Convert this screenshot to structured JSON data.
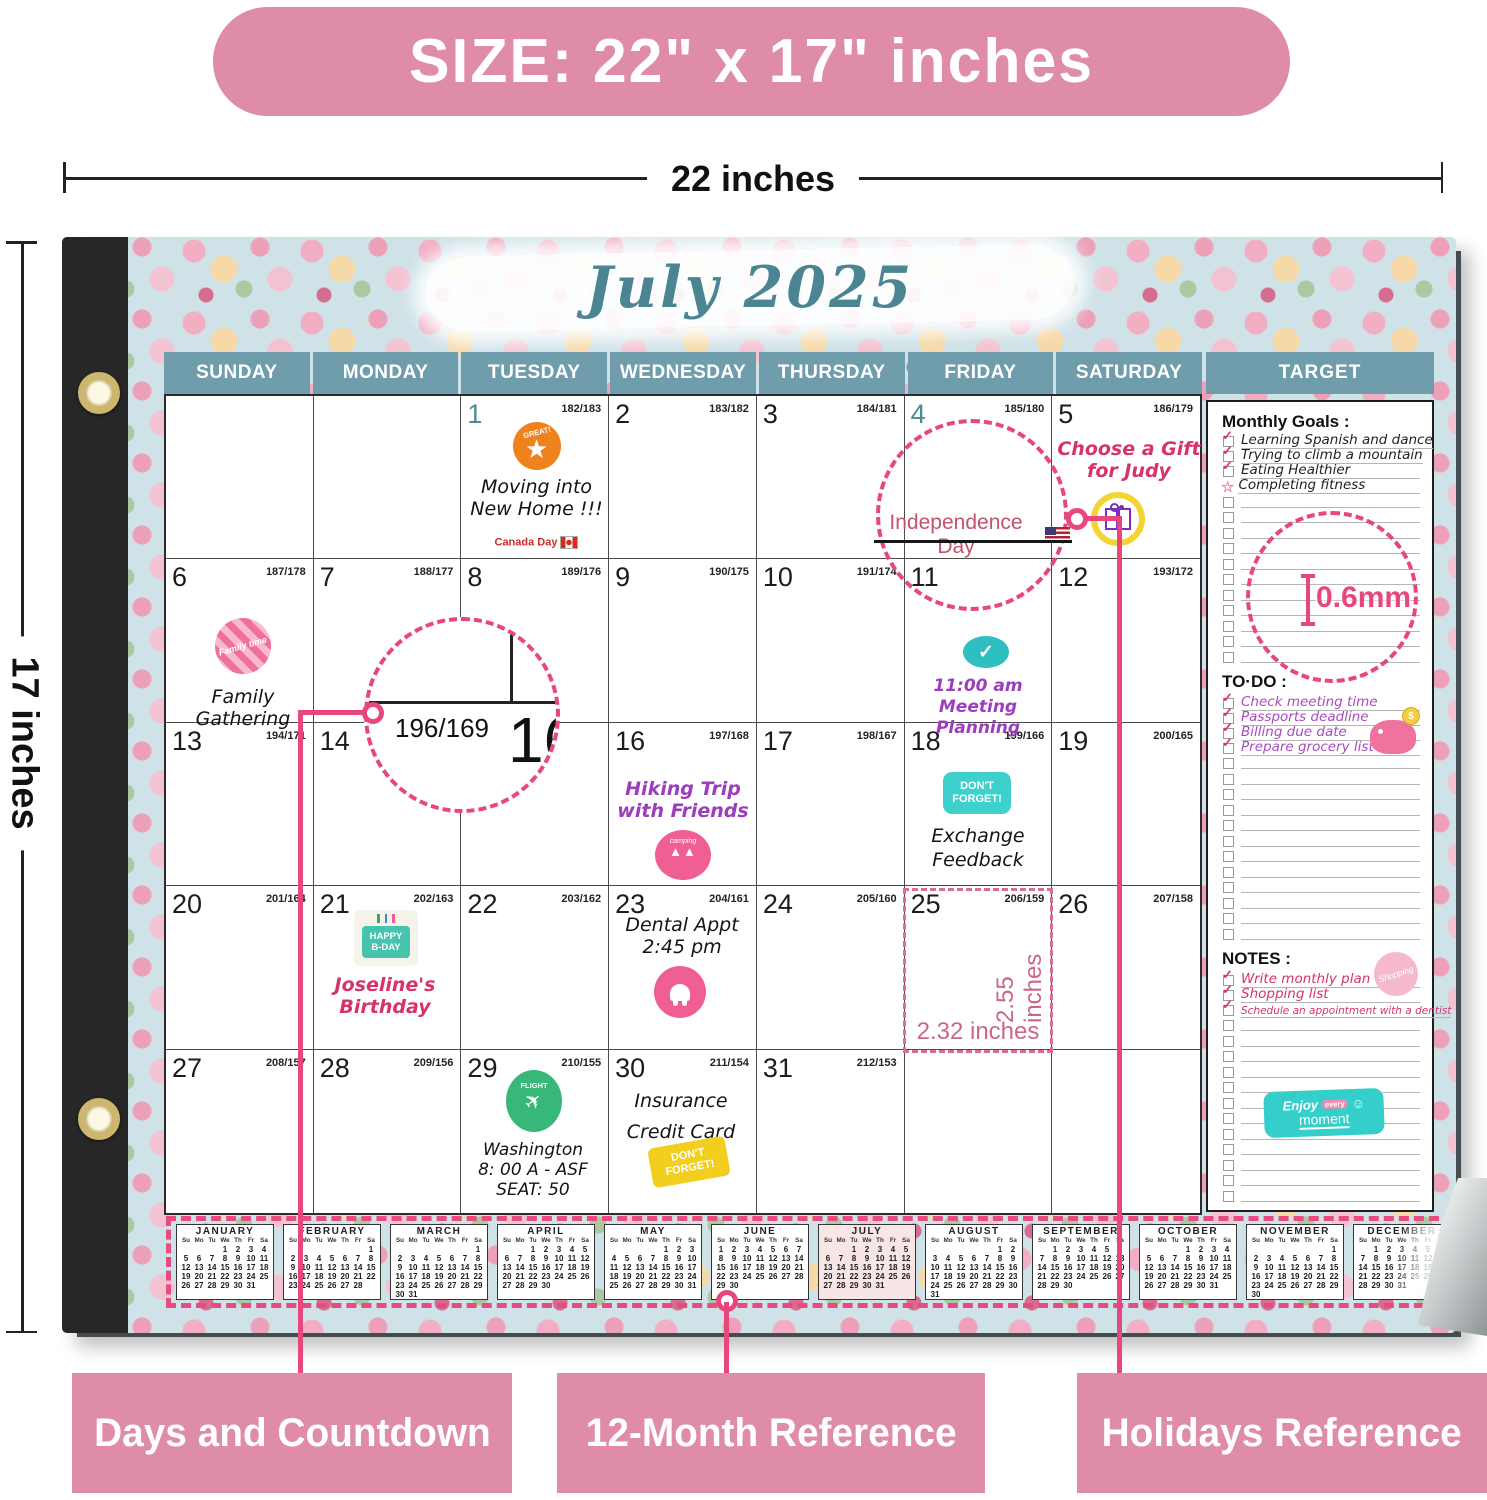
{
  "size_banner": "SIZE: 22\" x 17\" inches",
  "dim_width": "22 inches",
  "dim_height": "17 inches",
  "month_title": "July 2025",
  "day_headers": [
    "SUNDAY",
    "MONDAY",
    "TUESDAY",
    "WEDNESDAY",
    "THURSDAY",
    "FRIDAY",
    "SATURDAY"
  ],
  "target_header": "TARGET",
  "grid": {
    "cells": [
      {
        "day": "",
        "cd": ""
      },
      {
        "day": "",
        "cd": ""
      },
      {
        "day": "1",
        "cd": "182/183",
        "teal": true
      },
      {
        "day": "2",
        "cd": "183/182"
      },
      {
        "day": "3",
        "cd": "184/181"
      },
      {
        "day": "4",
        "cd": "185/180",
        "teal": true
      },
      {
        "day": "5",
        "cd": "186/179"
      },
      {
        "day": "6",
        "cd": "187/178"
      },
      {
        "day": "7",
        "cd": "188/177"
      },
      {
        "day": "8",
        "cd": "189/176"
      },
      {
        "day": "9",
        "cd": "190/175"
      },
      {
        "day": "10",
        "cd": "191/174"
      },
      {
        "day": "11",
        "cd": ""
      },
      {
        "day": "12",
        "cd": "193/172"
      },
      {
        "day": "13",
        "cd": "194/171"
      },
      {
        "day": "14",
        "cd": ""
      },
      {
        "day": "",
        "cd": ""
      },
      {
        "day": "16",
        "cd": "197/168"
      },
      {
        "day": "17",
        "cd": "198/167"
      },
      {
        "day": "18",
        "cd": "199/166"
      },
      {
        "day": "19",
        "cd": "200/165"
      },
      {
        "day": "20",
        "cd": "201/164"
      },
      {
        "day": "21",
        "cd": "202/163"
      },
      {
        "day": "22",
        "cd": "203/162"
      },
      {
        "day": "23",
        "cd": "204/161"
      },
      {
        "day": "24",
        "cd": "205/160"
      },
      {
        "day": "25",
        "cd": "206/159"
      },
      {
        "day": "26",
        "cd": "207/158"
      },
      {
        "day": "27",
        "cd": "208/157"
      },
      {
        "day": "28",
        "cd": "209/156"
      },
      {
        "day": "29",
        "cd": "210/155"
      },
      {
        "day": "30",
        "cd": "211/154"
      },
      {
        "day": "31",
        "cd": "212/153"
      },
      {
        "day": "",
        "cd": ""
      },
      {
        "day": "",
        "cd": ""
      }
    ]
  },
  "events": {
    "jul1": {
      "sticker": "GREAT!",
      "lines": [
        "Moving into",
        "New Home !!!"
      ],
      "holiday": "Canada Day"
    },
    "jul4": {
      "holiday": "Independence Day"
    },
    "jul5": {
      "lines": [
        "Choose a Gift",
        "for Judy"
      ]
    },
    "jul6": {
      "sticker": "Family time",
      "lines": [
        "Family",
        "Gathering"
      ]
    },
    "jul11": {
      "lines": [
        "11:00 am",
        "Meeting Planning"
      ],
      "check_icon": "✓"
    },
    "jul16": {
      "lines": [
        "Hiking Trip",
        "with Friends"
      ],
      "sticker": "camping",
      "tents": "▲▲"
    },
    "jul18": {
      "sticker_lines": [
        "DON'T",
        "FORGET!"
      ],
      "lines": [
        "Exchange",
        "Feedback"
      ]
    },
    "jul21": {
      "sticker_lines": [
        "HAPPY",
        "B-DAY"
      ],
      "lines": [
        "Joseline's",
        "Birthday"
      ]
    },
    "jul23": {
      "lines": [
        "Dental Appt",
        "2:45 pm"
      ]
    },
    "jul29": {
      "sticker": "FLIGHT",
      "plane_icon": "✈",
      "lines": [
        "Washington",
        "8: 00 A - ASF",
        "SEAT: 50"
      ]
    },
    "jul30": {
      "lines": [
        "Insurance",
        "Credit Card"
      ],
      "sticker_lines": [
        "DON'T",
        "FORGET!"
      ]
    }
  },
  "magnifier": {
    "countdown": "196/169",
    "big_day": "16"
  },
  "measure_cell": {
    "width_label": "2.32 inches",
    "height_label": "2.55 inches"
  },
  "target": {
    "goals_title": "Monthly Goals :",
    "goals": [
      "Learning Spanish and dance",
      "Trying to climb a mountain",
      "Eating Healthier",
      "Completing fitness"
    ],
    "measure_label": "0.6mm",
    "todo_title": "TO·DO :",
    "todos": [
      "Check meeting time",
      "Passports deadline",
      "Billing due date",
      "Prepare grocery list"
    ],
    "notes_title": "NOTES :",
    "notes": [
      "Write monthly plan",
      "Shopping list",
      "Schedule an appointment with a dentist"
    ],
    "coin_label": "$",
    "shopping_sticker": "Shopping",
    "moment_sticker": {
      "l1": "Enjoy",
      "l2": "every",
      "l3": "moment",
      "smiley": "☺"
    }
  },
  "mini_calendar": {
    "day_header": [
      "Su",
      "Mo",
      "Tu",
      "We",
      "Th",
      "Fr",
      "Sa"
    ],
    "months": [
      {
        "name": "JANUARY",
        "weeks": [
          [
            "",
            "",
            "",
            "1",
            "2",
            "3",
            "4"
          ],
          [
            "5",
            "6",
            "7",
            "8",
            "9",
            "10",
            "11"
          ],
          [
            "12",
            "13",
            "14",
            "15",
            "16",
            "17",
            "18"
          ],
          [
            "19",
            "20",
            "21",
            "22",
            "23",
            "24",
            "25"
          ],
          [
            "26",
            "27",
            "28",
            "29",
            "30",
            "31",
            ""
          ]
        ]
      },
      {
        "name": "FEBRUARY",
        "weeks": [
          [
            "",
            "",
            "",
            "",
            "",
            "",
            "1"
          ],
          [
            "2",
            "3",
            "4",
            "5",
            "6",
            "7",
            "8"
          ],
          [
            "9",
            "10",
            "11",
            "12",
            "13",
            "14",
            "15"
          ],
          [
            "16",
            "17",
            "18",
            "19",
            "20",
            "21",
            "22"
          ],
          [
            "23",
            "24",
            "25",
            "26",
            "27",
            "28",
            ""
          ]
        ]
      },
      {
        "name": "MARCH",
        "weeks": [
          [
            "",
            "",
            "",
            "",
            "",
            "",
            "1"
          ],
          [
            "2",
            "3",
            "4",
            "5",
            "6",
            "7",
            "8"
          ],
          [
            "9",
            "10",
            "11",
            "12",
            "13",
            "14",
            "15"
          ],
          [
            "16",
            "17",
            "18",
            "19",
            "20",
            "21",
            "22"
          ],
          [
            "23",
            "24",
            "25",
            "26",
            "27",
            "28",
            "29"
          ],
          [
            "30",
            "31",
            "",
            "",
            "",
            "",
            ""
          ]
        ]
      },
      {
        "name": "APRIL",
        "weeks": [
          [
            "",
            "",
            "1",
            "2",
            "3",
            "4",
            "5"
          ],
          [
            "6",
            "7",
            "8",
            "9",
            "10",
            "11",
            "12"
          ],
          [
            "13",
            "14",
            "15",
            "16",
            "17",
            "18",
            "19"
          ],
          [
            "20",
            "21",
            "22",
            "23",
            "24",
            "25",
            "26"
          ],
          [
            "27",
            "28",
            "29",
            "30",
            "",
            "",
            ""
          ]
        ]
      },
      {
        "name": "MAY",
        "weeks": [
          [
            "",
            "",
            "",
            "",
            "1",
            "2",
            "3"
          ],
          [
            "4",
            "5",
            "6",
            "7",
            "8",
            "9",
            "10"
          ],
          [
            "11",
            "12",
            "13",
            "14",
            "15",
            "16",
            "17"
          ],
          [
            "18",
            "19",
            "20",
            "21",
            "22",
            "23",
            "24"
          ],
          [
            "25",
            "26",
            "27",
            "28",
            "29",
            "30",
            "31"
          ]
        ]
      },
      {
        "name": "JUNE",
        "weeks": [
          [
            "1",
            "2",
            "3",
            "4",
            "5",
            "6",
            "7"
          ],
          [
            "8",
            "9",
            "10",
            "11",
            "12",
            "13",
            "14"
          ],
          [
            "15",
            "16",
            "17",
            "18",
            "19",
            "20",
            "21"
          ],
          [
            "22",
            "23",
            "24",
            "25",
            "26",
            "27",
            "28"
          ],
          [
            "29",
            "30",
            "",
            "",
            "",
            "",
            ""
          ]
        ]
      },
      {
        "name": "JULY",
        "highlight": true,
        "weeks": [
          [
            "",
            "",
            "1",
            "2",
            "3",
            "4",
            "5"
          ],
          [
            "6",
            "7",
            "8",
            "9",
            "10",
            "11",
            "12"
          ],
          [
            "13",
            "14",
            "15",
            "16",
            "17",
            "18",
            "19"
          ],
          [
            "20",
            "21",
            "22",
            "23",
            "24",
            "25",
            "26"
          ],
          [
            "27",
            "28",
            "29",
            "30",
            "31",
            "",
            ""
          ]
        ]
      },
      {
        "name": "AUGUST",
        "weeks": [
          [
            "",
            "",
            "",
            "",
            "",
            "1",
            "2"
          ],
          [
            "3",
            "4",
            "5",
            "6",
            "7",
            "8",
            "9"
          ],
          [
            "10",
            "11",
            "12",
            "13",
            "14",
            "15",
            "16"
          ],
          [
            "17",
            "18",
            "19",
            "20",
            "21",
            "22",
            "23"
          ],
          [
            "24",
            "25",
            "26",
            "27",
            "28",
            "29",
            "30"
          ],
          [
            "31",
            "",
            "",
            "",
            "",
            "",
            ""
          ]
        ]
      },
      {
        "name": "SEPTEMBER",
        "weeks": [
          [
            "",
            "1",
            "2",
            "3",
            "4",
            "5",
            "6"
          ],
          [
            "7",
            "8",
            "9",
            "10",
            "11",
            "12",
            "13"
          ],
          [
            "14",
            "15",
            "16",
            "17",
            "18",
            "19",
            "20"
          ],
          [
            "21",
            "22",
            "23",
            "24",
            "25",
            "26",
            "27"
          ],
          [
            "28",
            "29",
            "30",
            "",
            "",
            "",
            ""
          ]
        ]
      },
      {
        "name": "OCTOBER",
        "weeks": [
          [
            "",
            "",
            "",
            "1",
            "2",
            "3",
            "4"
          ],
          [
            "5",
            "6",
            "7",
            "8",
            "9",
            "10",
            "11"
          ],
          [
            "12",
            "13",
            "14",
            "15",
            "16",
            "17",
            "18"
          ],
          [
            "19",
            "20",
            "21",
            "22",
            "23",
            "24",
            "25"
          ],
          [
            "26",
            "27",
            "28",
            "29",
            "30",
            "31",
            ""
          ]
        ]
      },
      {
        "name": "NOVEMBER",
        "weeks": [
          [
            "",
            "",
            "",
            "",
            "",
            "",
            "1"
          ],
          [
            "2",
            "3",
            "4",
            "5",
            "6",
            "7",
            "8"
          ],
          [
            "9",
            "10",
            "11",
            "12",
            "13",
            "14",
            "15"
          ],
          [
            "16",
            "17",
            "18",
            "19",
            "20",
            "21",
            "22"
          ],
          [
            "23",
            "24",
            "25",
            "26",
            "27",
            "28",
            "29"
          ],
          [
            "30",
            "",
            "",
            "",
            "",
            "",
            ""
          ]
        ]
      },
      {
        "name": "DECEMBER",
        "fade": true,
        "weeks": [
          [
            "",
            "1",
            "2",
            "3",
            "4",
            "5",
            "6"
          ],
          [
            "7",
            "8",
            "9",
            "10",
            "11",
            "12",
            "13"
          ],
          [
            "14",
            "15",
            "16",
            "17",
            "18",
            "19",
            "20"
          ],
          [
            "21",
            "22",
            "23",
            "24",
            "25",
            "26",
            "27"
          ],
          [
            "28",
            "29",
            "30",
            "31",
            "",
            "",
            ""
          ]
        ]
      }
    ]
  },
  "footer_labels": [
    "Days and Countdown",
    "12-Month Reference",
    "Holidays Reference"
  ],
  "colors": {
    "accent_pink": "#e8477e",
    "label_pink": "#df8ca6",
    "header_teal": "#6f9dab",
    "title_teal": "#4c8592"
  }
}
